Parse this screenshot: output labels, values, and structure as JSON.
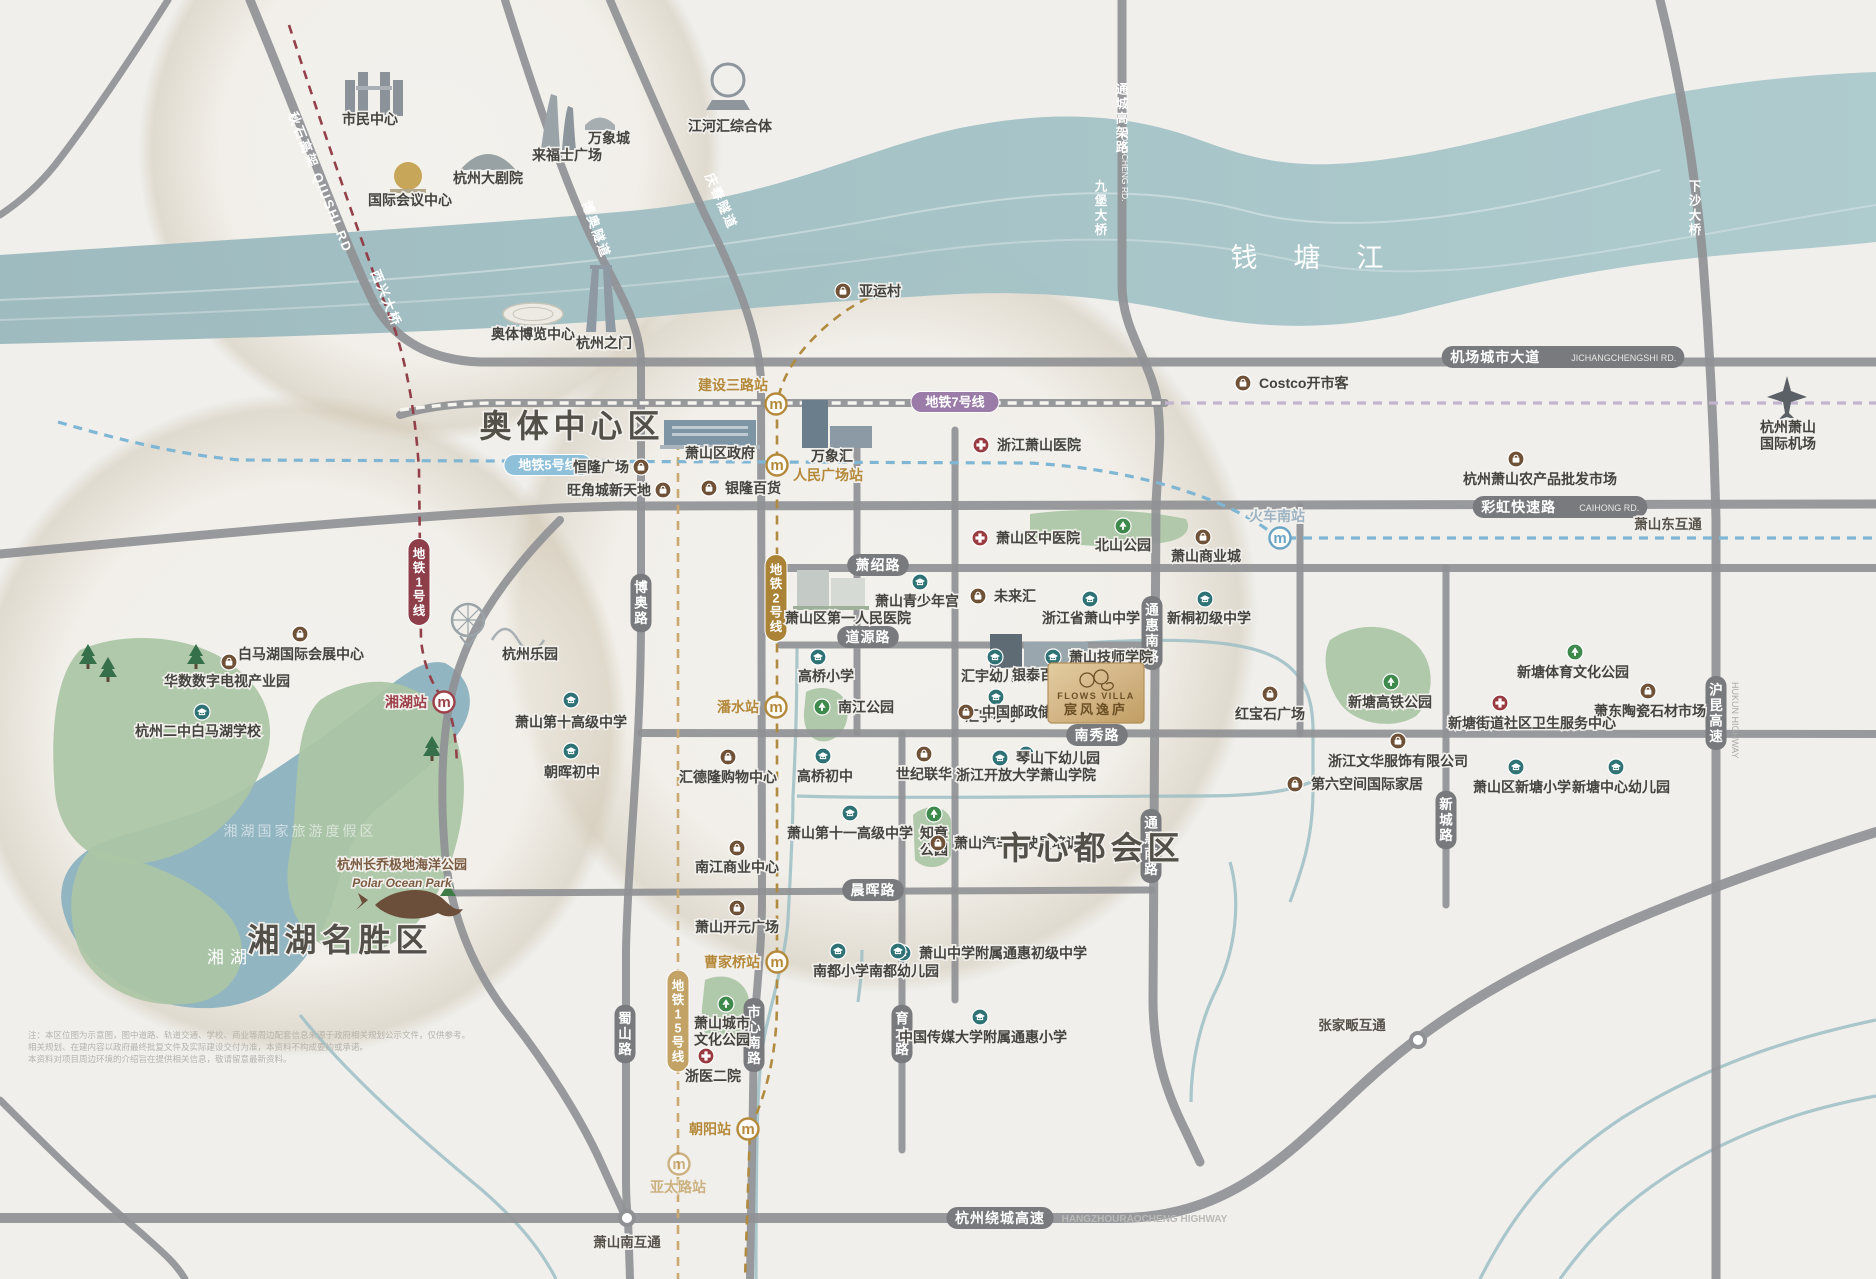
{
  "map": {
    "property": {
      "en": "FLOWS VILLA",
      "zh": "宸风逸庐",
      "x": 1096,
      "y": 693,
      "accent": "#c9a468",
      "text_color": "#6b5026"
    },
    "region_labels": [
      {
        "text": "奥体中心区",
        "x": 572,
        "y": 437,
        "size": 32,
        "color": "#534f49",
        "ls": 5,
        "bold": true
      },
      {
        "text": "市心都会区",
        "x": 1092,
        "y": 859,
        "size": 32,
        "color": "#534f49",
        "ls": 5,
        "bold": true
      },
      {
        "text": "湘湖名胜区",
        "x": 340,
        "y": 951,
        "size": 32,
        "color": "#534f49",
        "ls": 5,
        "bold": true
      },
      {
        "text": "钱塘江",
        "x": 1325,
        "y": 267,
        "size": 27,
        "color": "#ffffff",
        "ls": 36,
        "bold": false
      },
      {
        "text": "湘湖",
        "x": 230,
        "y": 963,
        "size": 17,
        "color": "#ffffff",
        "ls": 6,
        "bold": false
      },
      {
        "text": "湘湖国家旅游度假区",
        "x": 300,
        "y": 836,
        "size": 14,
        "color": "#ffffff",
        "ls": 3,
        "bold": false,
        "opacity": 0.55
      }
    ],
    "metro_badges": [
      {
        "t": "地铁1号线",
        "x": 419,
        "y": 582,
        "vert": true,
        "bg": "#8e3e48"
      },
      {
        "t": "地铁2号线",
        "x": 776,
        "y": 598,
        "vert": true,
        "bg": "#ab8337"
      },
      {
        "t": "地铁15号线",
        "x": 678,
        "y": 1021,
        "vert": true,
        "bg": "#c3a266"
      },
      {
        "t": "地铁5号线",
        "x": 548,
        "y": 465,
        "vert": false,
        "bg": "#8fc0da"
      },
      {
        "t": "地铁7号线",
        "x": 955,
        "y": 402,
        "vert": false,
        "bg": "#9b7ba8"
      }
    ],
    "stations": [
      {
        "name": "建设三路站",
        "x": 776,
        "y": 404,
        "lx": 733,
        "ly": 390,
        "anchor": "middle",
        "color": "gold"
      },
      {
        "name": "人民广场站",
        "x": 777,
        "y": 465,
        "lx": 793,
        "ly": 480,
        "anchor": "start",
        "color": "gold"
      },
      {
        "name": "潘水站",
        "x": 776,
        "y": 707,
        "lx": 759,
        "ly": 712,
        "anchor": "end",
        "color": "gold"
      },
      {
        "name": "曹家桥站",
        "x": 777,
        "y": 962,
        "lx": 760,
        "ly": 967,
        "anchor": "end",
        "color": "gold"
      },
      {
        "name": "朝阳站",
        "x": 748,
        "y": 1129,
        "lx": 731,
        "ly": 1134,
        "anchor": "end",
        "color": "gold"
      },
      {
        "name": "亚太路站",
        "x": 679,
        "y": 1164,
        "lx": 678,
        "ly": 1192,
        "anchor": "middle",
        "color": "gold",
        "faded": true
      },
      {
        "name": "湘湖站",
        "x": 444,
        "y": 702,
        "lx": 427,
        "ly": 707,
        "anchor": "end",
        "color": "red"
      },
      {
        "name": "火车南站",
        "x": 1280,
        "y": 538,
        "lx": 1277,
        "ly": 521,
        "anchor": "middle",
        "color": "blue"
      }
    ],
    "road_badges": [
      {
        "t": "萧绍路",
        "x": 878,
        "y": 565,
        "k": "pill"
      },
      {
        "t": "道源路",
        "x": 868,
        "y": 637,
        "k": "pill"
      },
      {
        "t": "南秀路",
        "x": 1097,
        "y": 735,
        "k": "pill"
      },
      {
        "t": "晨晖路",
        "x": 873,
        "y": 890,
        "k": "pill"
      },
      {
        "t": "市心南路",
        "x": 754,
        "y": 1035,
        "k": "vpill"
      },
      {
        "t": "育才路",
        "x": 902,
        "y": 1034,
        "k": "vpill"
      },
      {
        "t": "蜀山路",
        "x": 625,
        "y": 1034,
        "k": "vpill"
      },
      {
        "t": "博奥路",
        "x": 641,
        "y": 603,
        "k": "vpill"
      },
      {
        "t": "通惠南路",
        "x": 1152,
        "y": 633,
        "k": "vpill"
      },
      {
        "t": "通惠南路",
        "x": 1151,
        "y": 846,
        "k": "vpill"
      },
      {
        "t": "新城路",
        "x": 1446,
        "y": 820,
        "k": "vpill"
      },
      {
        "t": "沪昆高速",
        "en": "HUKUN HIGHWAY",
        "x": 1716,
        "y": 713,
        "k": "vpill"
      },
      {
        "t": "机场城市大道",
        "en": "JICHANGCHENGSHI RD.",
        "x": 1563,
        "y": 357,
        "k": "pill"
      },
      {
        "t": "彩虹快速路",
        "en": "CAIHONG RD.",
        "x": 1560,
        "y": 507,
        "k": "pill"
      },
      {
        "t": "杭州绕城高速",
        "en": "HANGZHOURAOCHENG HIGHWAY",
        "x": 1000,
        "y": 1218,
        "k": "pill",
        "enOut": true
      },
      {
        "t": "秋石高架",
        "en": "QIUSHI RD",
        "x": 316,
        "y": 184,
        "k": "white",
        "rot": 68
      },
      {
        "t": "西兴大桥",
        "x": 382,
        "y": 300,
        "k": "white",
        "rot": 68
      },
      {
        "t": "博奥隧道",
        "x": 592,
        "y": 231,
        "k": "white",
        "rot": 70
      },
      {
        "t": "庆春隧道",
        "x": 717,
        "y": 203,
        "k": "white",
        "rot": 66
      },
      {
        "t": "通城高架路",
        "en": "TONGCHENG RD.",
        "x": 1122,
        "y": 118,
        "k": "wvert"
      },
      {
        "t": "九堡大桥",
        "x": 1101,
        "y": 208,
        "k": "wvert"
      },
      {
        "t": "下沙大桥",
        "x": 1695,
        "y": 208,
        "k": "wvert"
      },
      {
        "t": "萧山东互通",
        "x": 1668,
        "y": 529,
        "k": "plain"
      },
      {
        "t": "萧山南互通",
        "x": 627,
        "y": 1247,
        "k": "plain"
      },
      {
        "t": "张家畈互通",
        "x": 1352,
        "y": 1030,
        "k": "plain"
      }
    ],
    "pois": [
      {
        "label": "市民中心",
        "t": "plain",
        "lx": 370,
        "ly": 124
      },
      {
        "label": "国际会议中心",
        "t": "plain",
        "lx": 410,
        "ly": 205
      },
      {
        "label": "杭州大剧院",
        "t": "plain",
        "lx": 488,
        "ly": 183
      },
      {
        "label": "来福士广场",
        "t": "plain",
        "lx": 567,
        "ly": 160
      },
      {
        "label": "万象城",
        "t": "plain",
        "lx": 609,
        "ly": 143
      },
      {
        "label": "江河汇综合体",
        "t": "plain",
        "lx": 730,
        "ly": 131
      },
      {
        "label": "奥体博览中心",
        "t": "plain",
        "lx": 533,
        "ly": 339
      },
      {
        "label": "杭州之门",
        "t": "plain",
        "lx": 604,
        "ly": 348
      },
      {
        "label": "亚运村",
        "t": "shop",
        "ix": 843,
        "iy": 291,
        "lx": 859,
        "ly": 296,
        "mode": "ileft"
      },
      {
        "label": "Costco开市客",
        "t": "shop",
        "ix": 1243,
        "iy": 383,
        "lx": 1259,
        "ly": 388,
        "mode": "ileft"
      },
      {
        "label": "浙江萧山医院",
        "t": "hosp",
        "ix": 981,
        "iy": 445,
        "lx": 997,
        "ly": 450,
        "mode": "ileft"
      },
      {
        "label": "萧山区政府",
        "t": "plain",
        "lx": 720,
        "ly": 458
      },
      {
        "label": "万象汇",
        "t": "plain",
        "lx": 832,
        "ly": 461
      },
      {
        "label": "恒隆广场",
        "t": "shop",
        "ix": 641,
        "iy": 467,
        "lx": 629,
        "ly": 472,
        "mode": "iright"
      },
      {
        "label": "旺角城新天地",
        "t": "shop",
        "ix": 663,
        "iy": 490,
        "lx": 651,
        "ly": 495,
        "mode": "iright"
      },
      {
        "label": "银隆百货",
        "t": "shop",
        "ix": 709,
        "iy": 488,
        "lx": 725,
        "ly": 493,
        "mode": "ileft"
      },
      {
        "label": "萧山区中医院",
        "t": "hosp",
        "ix": 980,
        "iy": 538,
        "lx": 996,
        "ly": 543,
        "mode": "ileft"
      },
      {
        "label": "北山公园",
        "t": "park",
        "ix": 1123,
        "iy": 526,
        "lx": 1123,
        "ly": 550,
        "mode": "itop"
      },
      {
        "label": "萧山商业城",
        "t": "shop",
        "ix": 1203,
        "iy": 537,
        "lx": 1206,
        "ly": 561,
        "mode": "itop"
      },
      {
        "label": "杭州萧山农产品批发市场",
        "t": "shop",
        "ix": 1516,
        "iy": 459,
        "lx": 1540,
        "ly": 484,
        "mode": "itop"
      },
      {
        "label": "未来汇",
        "t": "shop",
        "ix": 978,
        "iy": 596,
        "lx": 994,
        "ly": 601,
        "mode": "ileft"
      },
      {
        "label": "萧山青少年宫",
        "t": "school",
        "ix": 920,
        "iy": 582,
        "lx": 917,
        "ly": 606,
        "mode": "itop"
      },
      {
        "label": "萧山区第一人民医院",
        "t": "plain",
        "lx": 848,
        "ly": 623
      },
      {
        "label": "浙江省萧山中学",
        "t": "school",
        "ix": 1090,
        "iy": 599,
        "lx": 1091,
        "ly": 623,
        "mode": "itop"
      },
      {
        "label": "新桐初级中学",
        "t": "school",
        "ix": 1205,
        "iy": 599,
        "lx": 1209,
        "ly": 623,
        "mode": "itop"
      },
      {
        "label": "萧山技师学院",
        "t": "school",
        "ix": 1053,
        "iy": 657,
        "lx": 1069,
        "ly": 662,
        "mode": "ileft"
      },
      {
        "label": "高桥小学",
        "t": "school",
        "ix": 818,
        "iy": 657,
        "lx": 826,
        "ly": 681,
        "mode": "itop"
      },
      {
        "label": "汇宇幼儿园",
        "t": "school",
        "ix": 995,
        "iy": 657,
        "lx": 996,
        "ly": 681,
        "mode": "itop"
      },
      {
        "label": "汇宇小学",
        "t": "school",
        "ix": 996,
        "iy": 697,
        "lx": 993,
        "ly": 721,
        "mode": "itop"
      },
      {
        "label": "南江公园",
        "t": "park",
        "ix": 822,
        "iy": 707,
        "lx": 838,
        "ly": 712,
        "mode": "ileft"
      },
      {
        "label": "白马湖国际会展中心",
        "t": "shop",
        "ix": 300,
        "iy": 634,
        "lx": 301,
        "ly": 659,
        "mode": "itop"
      },
      {
        "label": "华数数字电视产业园",
        "t": "shop",
        "ix": 229,
        "iy": 662,
        "lx": 227,
        "ly": 686,
        "mode": "itop"
      },
      {
        "label": "杭州二中白马湖学校",
        "t": "school",
        "ix": 202,
        "iy": 712,
        "lx": 198,
        "ly": 736,
        "mode": "itop"
      },
      {
        "label": "杭州乐园",
        "t": "plain",
        "lx": 530,
        "ly": 659
      },
      {
        "label": "萧山第十高级中学",
        "t": "school",
        "ix": 571,
        "iy": 700,
        "lx": 571,
        "ly": 727,
        "mode": "itop"
      },
      {
        "label": "朝晖初中",
        "t": "school",
        "ix": 571,
        "iy": 751,
        "lx": 572,
        "ly": 777,
        "mode": "itop"
      },
      {
        "label": "汇德隆购物中心",
        "t": "shop",
        "ix": 728,
        "iy": 757,
        "lx": 728,
        "ly": 782,
        "mode": "itop"
      },
      {
        "label": "高桥初中",
        "t": "school",
        "ix": 823,
        "iy": 756,
        "lx": 825,
        "ly": 781,
        "mode": "itop"
      },
      {
        "label": "世纪联华",
        "t": "shop",
        "ix": 924,
        "iy": 754,
        "lx": 924,
        "ly": 779,
        "mode": "itop"
      },
      {
        "label": "浙江开放大学萧山学院",
        "t": "school",
        "ix": 1026,
        "iy": 754,
        "lx": 1026,
        "ly": 780,
        "mode": "itop"
      },
      {
        "label": "红宝石广场",
        "t": "shop",
        "ix": 1270,
        "iy": 694,
        "lx": 1270,
        "ly": 719,
        "mode": "itop"
      },
      {
        "label": "银泰百货",
        "t": "plain",
        "lx": 1040,
        "ly": 680
      },
      {
        "label": "中国邮政储蓄银行",
        "t": "shop",
        "ix": 966,
        "iy": 712,
        "lx": 982,
        "ly": 717,
        "mode": "ileft"
      },
      {
        "label": "琴山下幼儿园",
        "t": "school",
        "ix": 1000,
        "iy": 758,
        "lx": 1016,
        "ly": 763,
        "mode": "ileft"
      },
      {
        "label": "第六空间国际家居",
        "t": "shop",
        "ix": 1295,
        "iy": 784,
        "lx": 1311,
        "ly": 789,
        "mode": "ileft"
      },
      {
        "label": "萧山区新塘小学",
        "t": "school",
        "ix": 1516,
        "iy": 767,
        "lx": 1522,
        "ly": 792,
        "mode": "itop"
      },
      {
        "label": "新塘中心幼儿园",
        "t": "school",
        "ix": 1616,
        "iy": 767,
        "lx": 1621,
        "ly": 792,
        "mode": "itop"
      },
      {
        "label": "新塘体育文化公园",
        "t": "park",
        "ix": 1575,
        "iy": 652,
        "lx": 1573,
        "ly": 677,
        "mode": "itop"
      },
      {
        "label": "萧东陶瓷石材市场",
        "t": "shop",
        "ix": 1648,
        "iy": 691,
        "lx": 1650,
        "ly": 716,
        "mode": "itop"
      },
      {
        "label": "新塘街道社区卫生服务中心",
        "t": "hosp",
        "ix": 1500,
        "iy": 703,
        "lx": 1532,
        "ly": 728,
        "mode": "itop"
      },
      {
        "label": "新塘高铁公园",
        "t": "park",
        "ix": 1391,
        "iy": 682,
        "lx": 1390,
        "ly": 707,
        "mode": "itop"
      },
      {
        "label": "浙江文华服饰有限公司",
        "t": "shop",
        "ix": 1398,
        "iy": 741,
        "lx": 1398,
        "ly": 766,
        "mode": "itop"
      },
      {
        "label": "萧山第十一高级中学",
        "t": "school",
        "ix": 850,
        "iy": 813,
        "lx": 850,
        "ly": 838,
        "mode": "itop"
      },
      {
        "label": "知章公园",
        "t": "park",
        "ix": 934,
        "iy": 814,
        "lines": [
          "知章",
          "公园"
        ],
        "lx": 934,
        "ly": 838,
        "mode": "itop"
      },
      {
        "label": "南江商业中心",
        "t": "shop",
        "ix": 737,
        "iy": 848,
        "lx": 737,
        "ly": 872,
        "mode": "itop"
      },
      {
        "label": "萧山开元广场",
        "t": "shop",
        "ix": 737,
        "iy": 908,
        "lx": 737,
        "ly": 932,
        "mode": "itop"
      },
      {
        "label": "萧山中学附属通惠初级中学",
        "t": "school",
        "ix": 903,
        "iy": 953,
        "lx": 919,
        "ly": 958,
        "mode": "ileft"
      },
      {
        "label": "萧山汽车驾驶员培训",
        "t": "shop",
        "ix": 938,
        "iy": 843,
        "lx": 954,
        "ly": 848,
        "mode": "ileft"
      },
      {
        "label": "南都小学",
        "t": "school",
        "ix": 838,
        "iy": 951,
        "lx": 841,
        "ly": 976,
        "mode": "itop"
      },
      {
        "label": "南都幼儿园",
        "t": "school",
        "ix": 898,
        "iy": 951,
        "lx": 904,
        "ly": 976,
        "mode": "itop"
      },
      {
        "label": "中国传媒大学附属通惠小学",
        "t": "school",
        "ix": 980,
        "iy": 1017,
        "lx": 983,
        "ly": 1042,
        "mode": "itop"
      },
      {
        "label": "萧山城市文化公园",
        "t": "park",
        "ix": 726,
        "iy": 1004,
        "lines": [
          "萧山城市",
          "文化公园"
        ],
        "lx": 722,
        "ly": 1028,
        "mode": "itop"
      },
      {
        "label": "浙医二院",
        "t": "hosp",
        "ix": 706,
        "iy": 1056,
        "lx": 713,
        "ly": 1081,
        "mode": "itop"
      },
      {
        "label": "杭州萧山国际机场",
        "t": "plain",
        "lines": [
          "杭州萧山",
          "国际机场"
        ],
        "lx": 1788,
        "ly": 432
      },
      {
        "label": "杭州长乔极地海洋公园",
        "t": "plain",
        "lx": 402,
        "ly": 869,
        "color": "#7a5b41",
        "size": 13
      },
      {
        "label": "Polar Ocean Park",
        "t": "plain",
        "lx": 402,
        "ly": 887,
        "color": "#7a5b41",
        "size": 12,
        "italic": true,
        "serif": true
      }
    ],
    "zones": [
      {
        "x": 430,
        "y": 150,
        "r": 292
      },
      {
        "x": 880,
        "y": 615,
        "r": 378
      },
      {
        "x": 295,
        "y": 725,
        "r": 332
      }
    ],
    "interchanges": [
      {
        "x": 627,
        "y": 1218
      },
      {
        "x": 1418,
        "y": 1040
      }
    ],
    "colors": {
      "school": "#2e7276",
      "park": "#3e8a4c",
      "hospital": "#993a40",
      "shop": "#6e5137",
      "road": "#909195",
      "badge": "#797a7e",
      "gold": "#b5893a",
      "red": "#9c4049",
      "blue": "#6aa4c4"
    },
    "disclaimer": [
      "注：本区位图为示意图，图中道路、轨道交通、学校、商业等周边配套信息来源于政府相关规划公示文件，仅供参考。",
      "相关规划、在建内容以政府最终批复文件及实际建设交付为准，本资料不构成要约或承诺。",
      "本资料对项目周边环境的介绍旨在提供相关信息，敬请留意最新资料。"
    ]
  }
}
